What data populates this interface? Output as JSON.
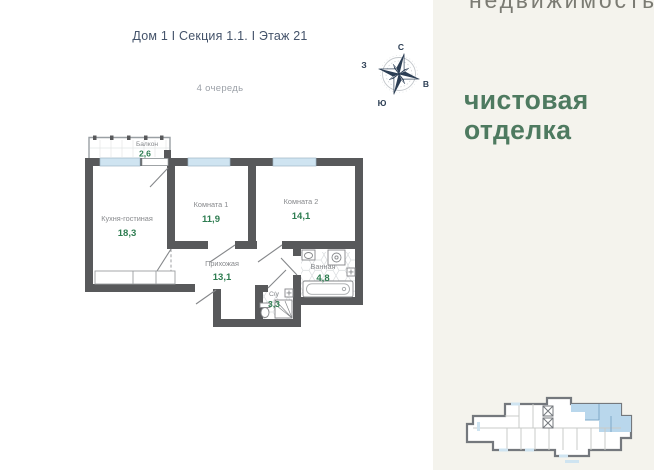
{
  "page": {
    "title": "Дом 1 I Секция 1.1. I Этаж 21",
    "phase": "4 очередь"
  },
  "compass": {
    "n": "С",
    "e": "В",
    "s": "Ю",
    "w": "З"
  },
  "plan": {
    "rooms": [
      {
        "name": "Балкон",
        "area": "2,6"
      },
      {
        "name": "Кухня-гостиная",
        "area": "18,3"
      },
      {
        "name": "Комната 1",
        "area": "11,9"
      },
      {
        "name": "Комната 2",
        "area": "14,1"
      },
      {
        "name": "Прихожая",
        "area": "13,1"
      },
      {
        "name": "Ванная",
        "area": "4,8"
      },
      {
        "name": "С/у",
        "area": "3,3"
      }
    ]
  },
  "panel": {
    "brand": "недвижимость",
    "finish": [
      "чистовая",
      "отделка"
    ]
  },
  "colors": {
    "wall": "#58595b",
    "window": "#cfe4f1",
    "area_green": "#2e7d51",
    "label_gray": "#87898c",
    "panel_bg": "#f4f3ed",
    "finish_green": "#4e7a60",
    "title_navy": "#44536a",
    "compass_navy": "#2c3e54",
    "unit_highlight": "#b9d7ec"
  }
}
